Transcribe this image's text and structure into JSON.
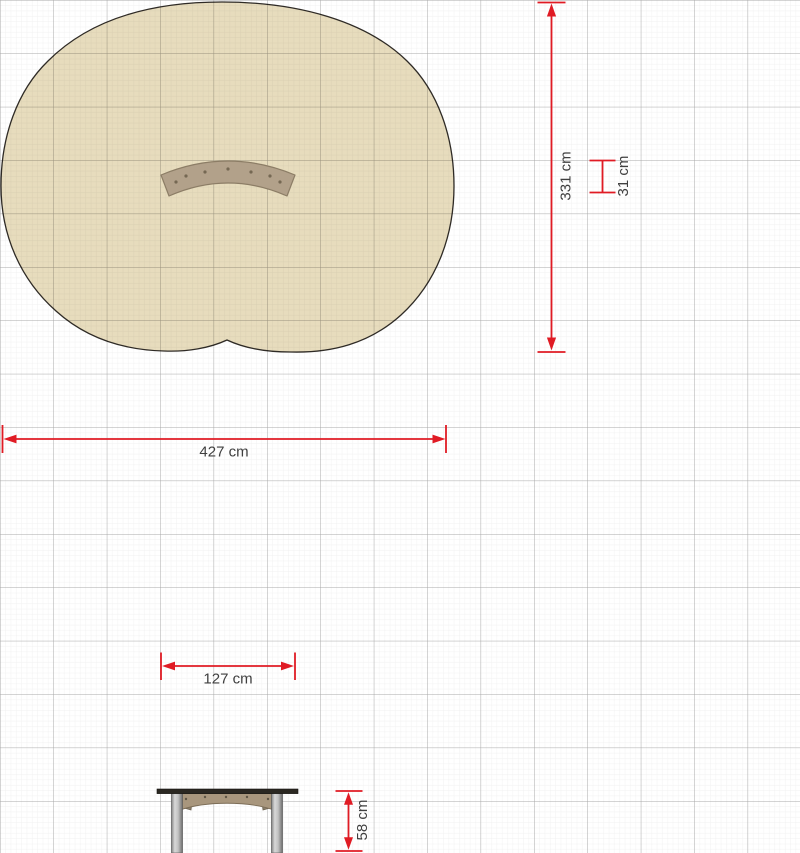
{
  "drawing": {
    "title": "playground-bench-dimension-drawing",
    "dimensions": {
      "zone_width": {
        "label": "427 cm",
        "value": 427,
        "unit": "cm"
      },
      "zone_height": {
        "label": "331 cm",
        "value": 331,
        "unit": "cm"
      },
      "bench_depth": {
        "label": "31 cm",
        "value": 31,
        "unit": "cm"
      },
      "bench_width": {
        "label": "127 cm",
        "value": 127,
        "unit": "cm"
      },
      "bench_height": {
        "label": "58 cm",
        "value": 58,
        "unit": "cm"
      }
    },
    "colors": {
      "dimension_red": "#e01b24",
      "label_text": "#3f3f3f",
      "safety_zone_fill": "#e7dcbd",
      "safety_zone_stroke": "#2f2b26",
      "bench_wood": "#b2a18a",
      "bench_wood_dark": "#8c7d66",
      "apron_wood": "#a8967d",
      "metal_leg_light": "#d8d8d8",
      "metal_leg_dark": "#6e6e6e",
      "grid_major": "#a8a8a8",
      "grid_minor": "#ededed",
      "background": "#ffffff"
    }
  }
}
